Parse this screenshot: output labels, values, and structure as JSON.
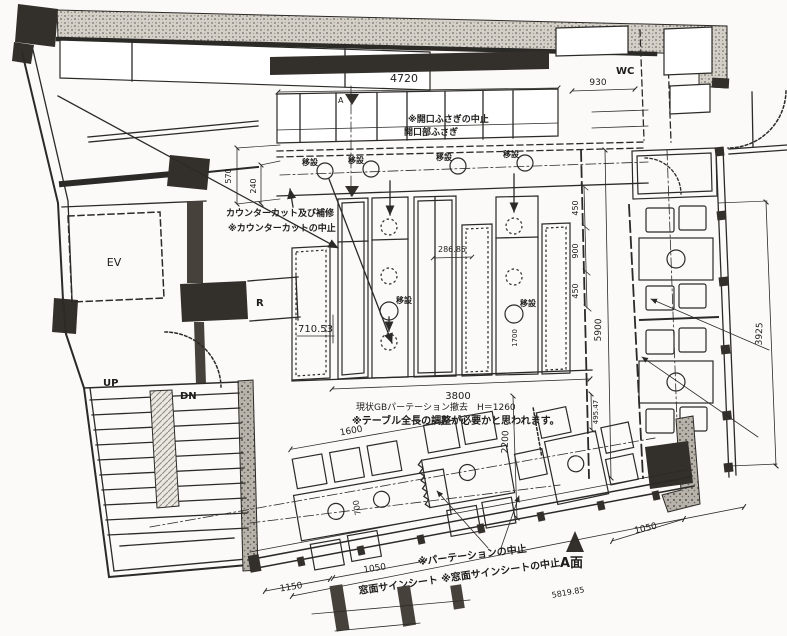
{
  "rooms": {
    "ev": "EV",
    "wc": "WC",
    "up": "UP",
    "dn": "DN",
    "r": "R"
  },
  "notes": {
    "opening1": "※開口ふさぎの中止",
    "opening2": "開口部ふさぎ",
    "counter1": "カウンターカット及び補修",
    "counter2": "※カウンターカットの中止",
    "gb1": "現状GBパーテーション撤去　H＝1260",
    "gb2": "※テーブル全長の調整が必要かと思われます。",
    "partition": "※パーテーションの中止",
    "window": "窓面サインシート ※窓面サインシートの中止",
    "aface": "A面",
    "relocate": "移設",
    "section": "A"
  },
  "dims": {
    "d4720": "4720",
    "d930": "930",
    "d570": "570",
    "d240": "240",
    "d450a": "450",
    "d900": "900",
    "d450b": "450",
    "d5900": "5900",
    "d3925": "3925",
    "d28685": "286.85",
    "d71053": "710.53",
    "d3800": "3800",
    "d49547": "495.47",
    "d1600": "1600",
    "d2200": "2200",
    "d700": "700",
    "d1700": "1700",
    "d1150": "1150",
    "d1050a": "1050",
    "d1050b": "1050",
    "d581985": "5819.85"
  },
  "colors": {
    "ink": "#2b2a27",
    "paper": "#fbfaf8",
    "wall": "#332f2b"
  }
}
